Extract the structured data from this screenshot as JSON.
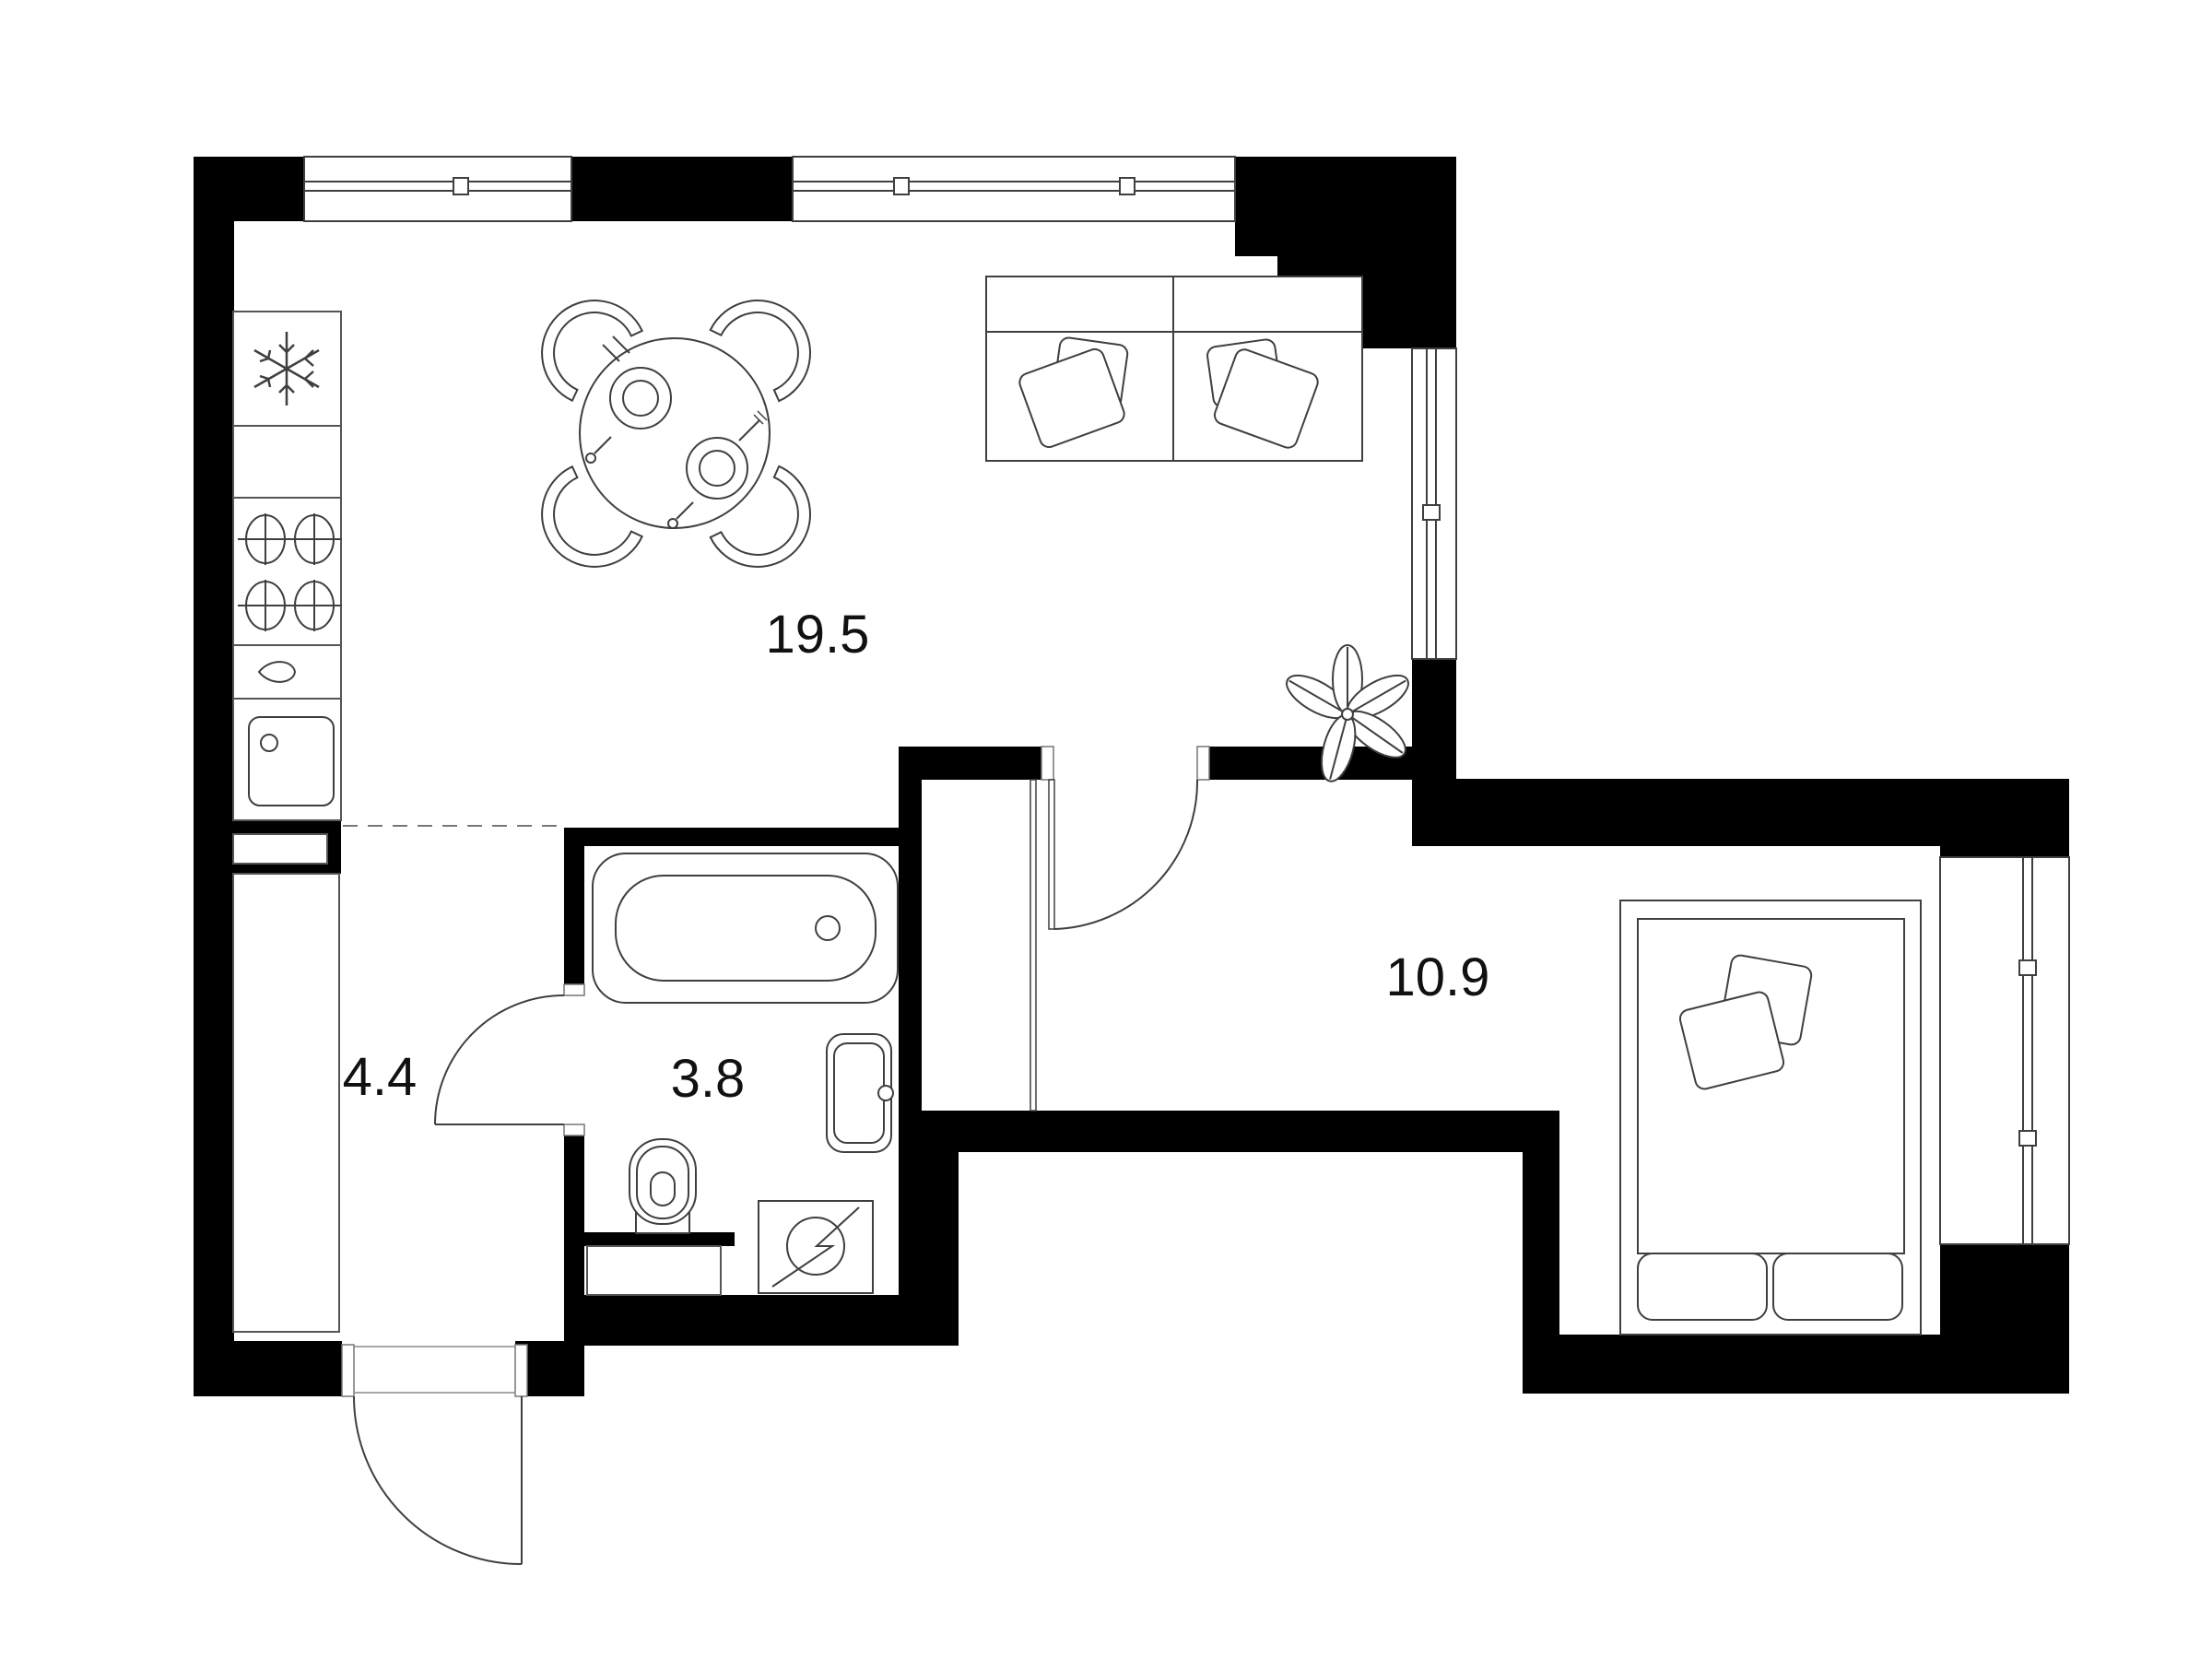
{
  "plan": {
    "type": "apartment-floor-plan",
    "rooms": [
      {
        "id": "kitchen-living",
        "area_label": "19.5"
      },
      {
        "id": "hallway",
        "area_label": "4.4"
      },
      {
        "id": "bathroom",
        "area_label": "3.8"
      },
      {
        "id": "bedroom",
        "area_label": "10.9"
      }
    ],
    "fixtures": [
      "refrigerator-snowflake",
      "kitchen-counter",
      "stove-4-burners",
      "faucet-drop",
      "kitchen-sink",
      "wardrobe",
      "dining-table-4-chairs",
      "sofa-2-seat-pillows",
      "plant-5-leaves",
      "bathtub",
      "washbasin",
      "toilet",
      "washing-machine",
      "duct-box",
      "double-bed-pillows",
      "entrance-door",
      "bathroom-door",
      "bedroom-door",
      "window-top-left",
      "window-top-right",
      "window-living-right",
      "window-bedroom-right"
    ],
    "palette": {
      "wall": "#000000",
      "line": "#3f3f3f",
      "line_light": "#8a8a8a",
      "background": "#ffffff",
      "label": "#111111"
    }
  }
}
